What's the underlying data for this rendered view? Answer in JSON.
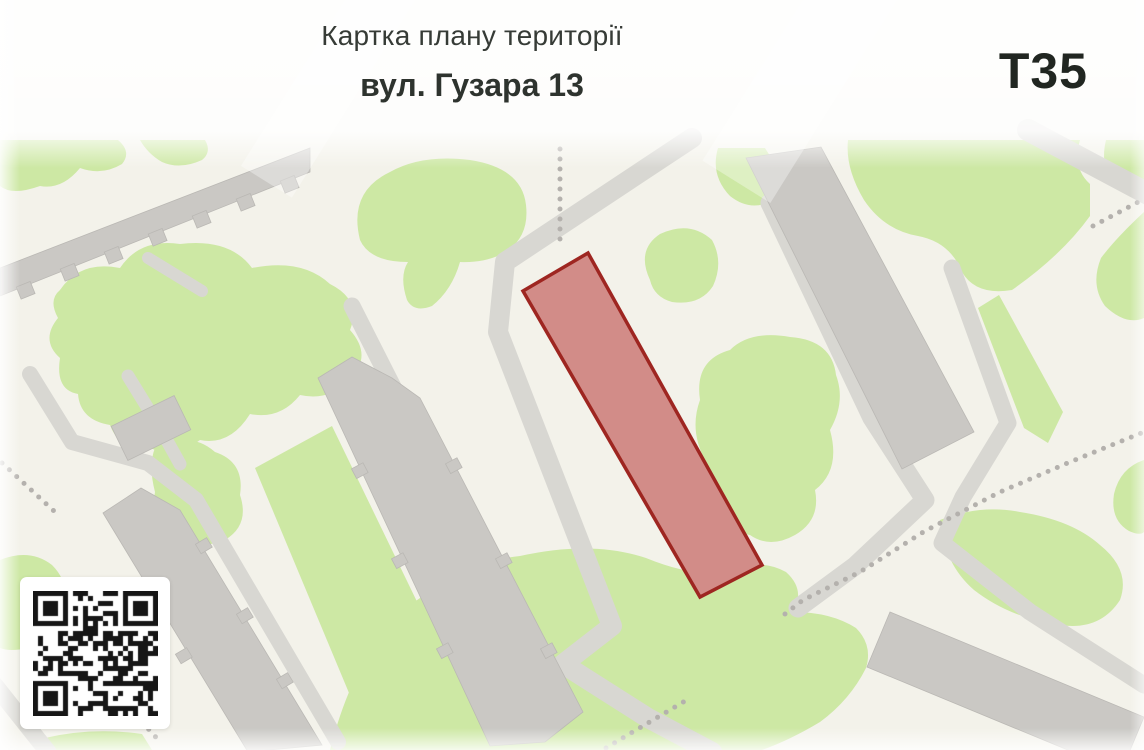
{
  "header": {
    "title": "Картка плану території",
    "subtitle": "вул. Гузара 13"
  },
  "badge": {
    "code": "Т35"
  },
  "map": {
    "parcel": {
      "fill": "#d28c88",
      "stroke": "#9e2621",
      "stroke_width": "3.5"
    },
    "colors": {
      "background": "#f3f2ea",
      "green_area": "#cde8a4",
      "road": "#d8d7d2",
      "building": "#cac8c4",
      "dotted_path": "#b4b1ad"
    }
  }
}
